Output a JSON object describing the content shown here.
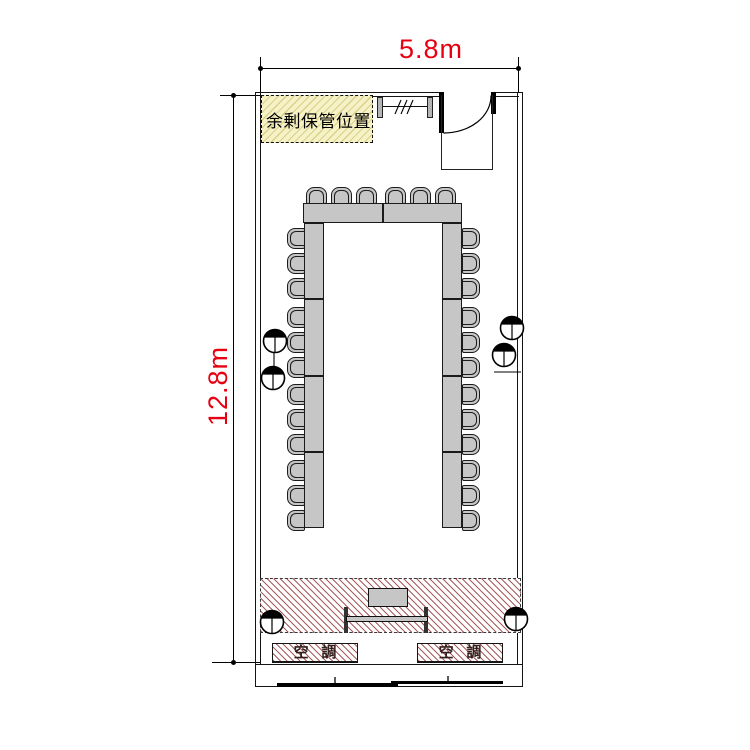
{
  "page": {
    "background": "#ffffff"
  },
  "dimensions": {
    "width": {
      "label": "5.8m"
    },
    "height": {
      "label": "12.8m"
    },
    "color": "#e60012"
  },
  "areas": {
    "storage": {
      "label": "余剰保管位置",
      "fill": "#f6f2c8"
    },
    "stage": {
      "hatch_color": "#993e3e"
    },
    "hvac_units": [
      {
        "label": "空調"
      },
      {
        "label": "空調"
      }
    ]
  },
  "furniture": {
    "layout": "U-shape",
    "top_table_segments": 2,
    "side_table_segments": 4,
    "top_seats": 6,
    "left_seats": 12,
    "right_seats": 12,
    "total_seats": 30
  },
  "symbols": {
    "outlet_count": 6,
    "door_count": 1,
    "whiteboard_count": 1
  }
}
